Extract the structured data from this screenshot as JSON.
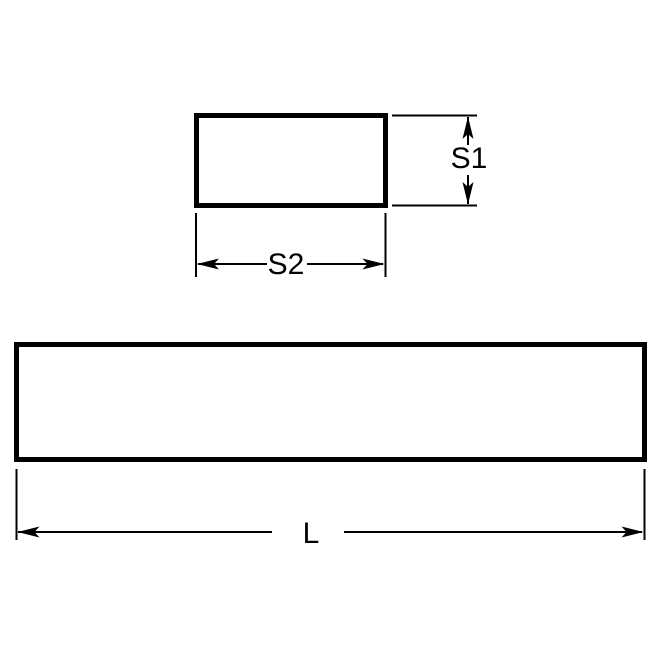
{
  "diagram": {
    "labels": {
      "s1": "S1",
      "s2": "S2",
      "length": "L"
    },
    "colors": {
      "line": "#000000",
      "background": "#ffffff"
    }
  }
}
